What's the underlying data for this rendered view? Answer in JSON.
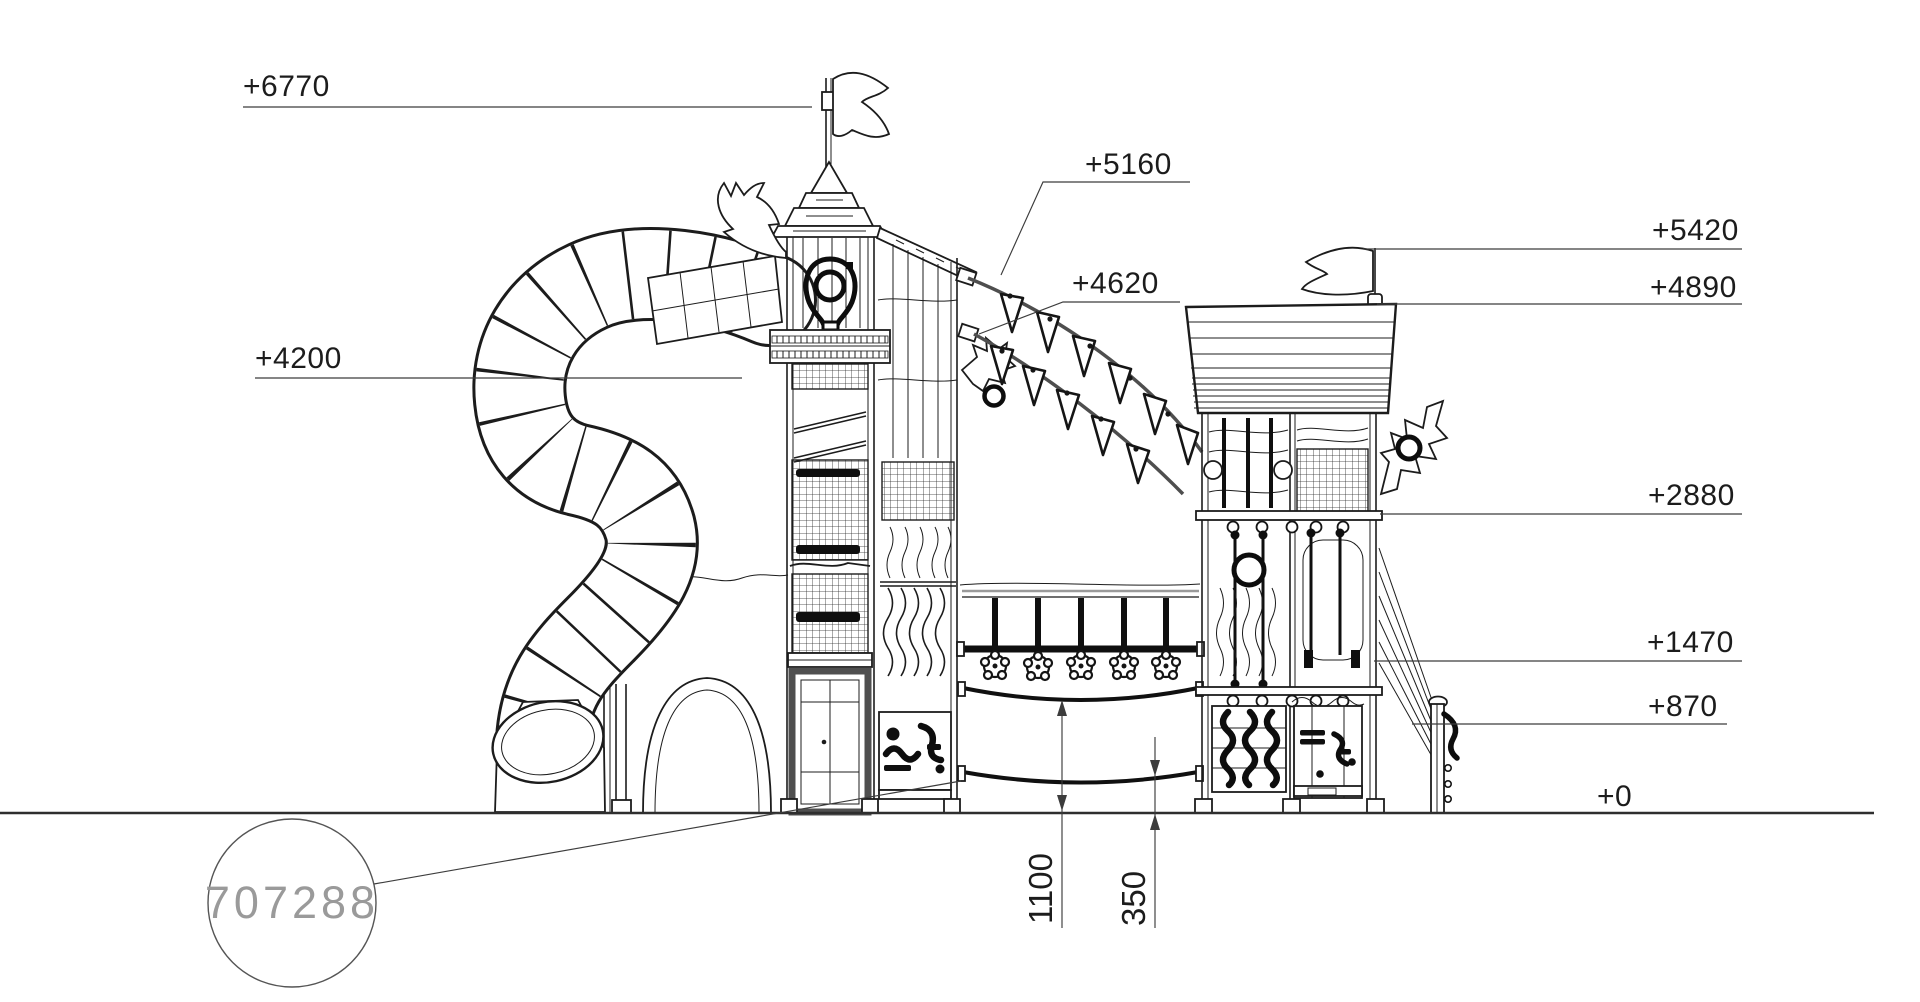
{
  "drawing": {
    "type": "playground-equipment-elevation",
    "background_color": "#ffffff",
    "line_color": "#1c1c1c",
    "dimension_line_color": "#3c3c3c",
    "part_number_color": "#9a9a9a",
    "labels": {
      "l6770": "+6770",
      "l5160": "+5160",
      "l4620": "+4620",
      "l4200": "+4200",
      "l5420": "+5420",
      "l4890": "+4890",
      "l2880": "+2880",
      "l1470": "+1470",
      "l870": "+870",
      "l0": "+0",
      "dim1100": "1100",
      "dim350": "350",
      "part_number": "707288"
    }
  }
}
